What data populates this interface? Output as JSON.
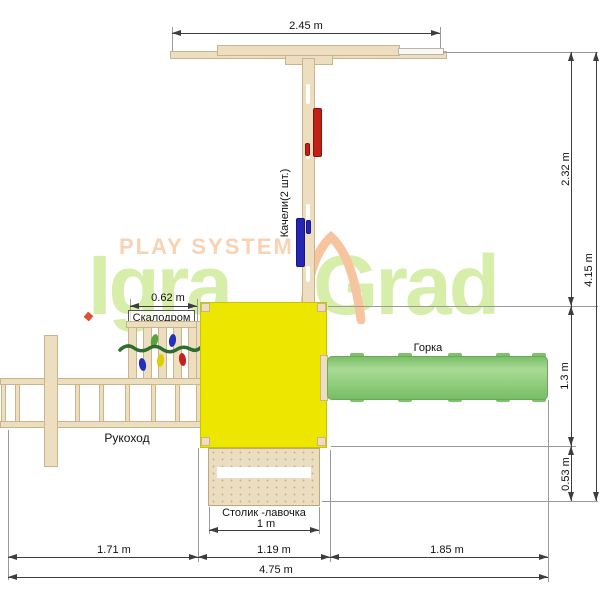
{
  "watermark": {
    "tagline": "PLAY SYSTEM",
    "brand_left": "Igra",
    "brand_right": "Grad"
  },
  "labels": {
    "swing": "Качели(2 шт.)",
    "climbing_wall": "Скалодром",
    "slide": "Горка",
    "monkey_bars": "Рукоход",
    "table_bench": "Столик -лавочка"
  },
  "dims": {
    "beam_width": "2.45 m",
    "upper_height": "2.32 m",
    "total_height": "4.15 m",
    "slide_zone_height": "1.3 m",
    "bench_zone_height": "0.53 m",
    "climb_width": "0.62 m",
    "table_width": "1 m",
    "left_span": "1.71 m",
    "mid_span": "1.19 m",
    "right_span": "1.85 m",
    "total_width": "4.75 m"
  },
  "colors": {
    "wood": "#ecdebf",
    "platform_yellow": "#ece600",
    "slide_green": "#8cc97d",
    "seat_red": "#c02015",
    "seat_blue": "#2525b0",
    "hold_green": "#58a43c",
    "hold_yellow": "#ddce00",
    "watermark_green": "#d7eeab",
    "watermark_peach": "#f8d2b3",
    "dimension_line": "#3d3d3d"
  }
}
